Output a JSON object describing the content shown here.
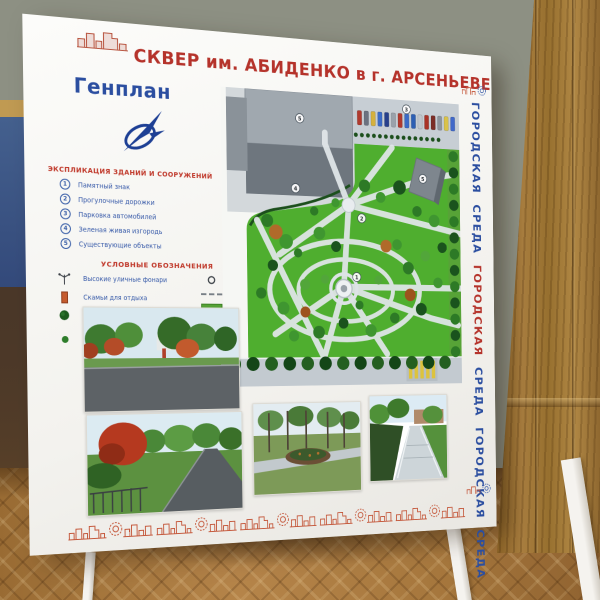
{
  "poster": {
    "header": {
      "title": "СКВЕР  им. АБИДЕНКО в г. АРСЕНЬЕВЕ",
      "plan_label": "Генплан"
    },
    "explication": {
      "heading": "ЭКСПЛИКАЦИЯ ЗДАНИЙ И СООРУЖЕНИЙ",
      "items": [
        {
          "num": "1",
          "label": "Памятный знак"
        },
        {
          "num": "2",
          "label": "Прогулочные дорожки"
        },
        {
          "num": "3",
          "label": "Парковка автомобилей"
        },
        {
          "num": "4",
          "label": "Зеленая живая изгородь"
        },
        {
          "num": "5",
          "label": "Существующие объекты"
        }
      ]
    },
    "legend": {
      "heading": "УСЛОВНЫЕ ОБОЗНАЧЕНИЯ",
      "left": [
        {
          "icon": "street-lamp-icon",
          "label": "Высокие уличные фонари"
        },
        {
          "icon": "bench-icon",
          "label": "Скамьи для отдыха"
        },
        {
          "icon": "deciduous-tree-icon",
          "label": "Посадки лиственных деревьев"
        },
        {
          "icon": "shrub-icon",
          "label": "Кустарники отдельно и в группах (декоративные, цветущие)"
        }
      ],
      "right": [
        {
          "icon": "park-lamp-icon",
          "label": "Парковые фонари"
        },
        {
          "icon": "sidewalk-fence-icon",
          "label": "Тротуарное ограждение"
        },
        {
          "icon": "lawn-icon",
          "label": "Газон"
        },
        {
          "icon": "asphalt-icon",
          "label": "Асфальтовое покрытие"
        }
      ]
    },
    "map": {
      "labels": {
        "existing_building": "5",
        "parking": "3",
        "existing_small": "5",
        "hedge": "4",
        "paths": "2",
        "memorial": "1"
      },
      "car_colors": [
        "#b03a2e",
        "#6b7280",
        "#d4b13f",
        "#3b6bc7",
        "#27408b",
        "#9aa2ab",
        "#b03a2e",
        "#3b6bc7",
        "#2d5fb3",
        "#c0c6cc",
        "#a93226",
        "#7b2d26",
        "#8d949c",
        "#d9c24a",
        "#4169c9"
      ]
    },
    "side_strip": {
      "words": [
        {
          "text": "ГОРОДСКАЯ",
          "color": "#2b4ea0"
        },
        {
          "text": "СРЕДА",
          "color": "#2b4ea0"
        },
        {
          "text": "ГОРОДСКАЯ",
          "color": "#b5332b"
        },
        {
          "text": "СРЕДА",
          "color": "#2b4ea0"
        },
        {
          "text": "ГОРОДСКАЯ",
          "color": "#2b4ea0"
        },
        {
          "text": "СРЕДА",
          "color": "#2b4ea0"
        }
      ]
    },
    "colors": {
      "title_red": "#b5332b",
      "brand_blue": "#2b4ea0",
      "accent_red": "#c4573a",
      "map_green": "#4fae2f"
    }
  }
}
